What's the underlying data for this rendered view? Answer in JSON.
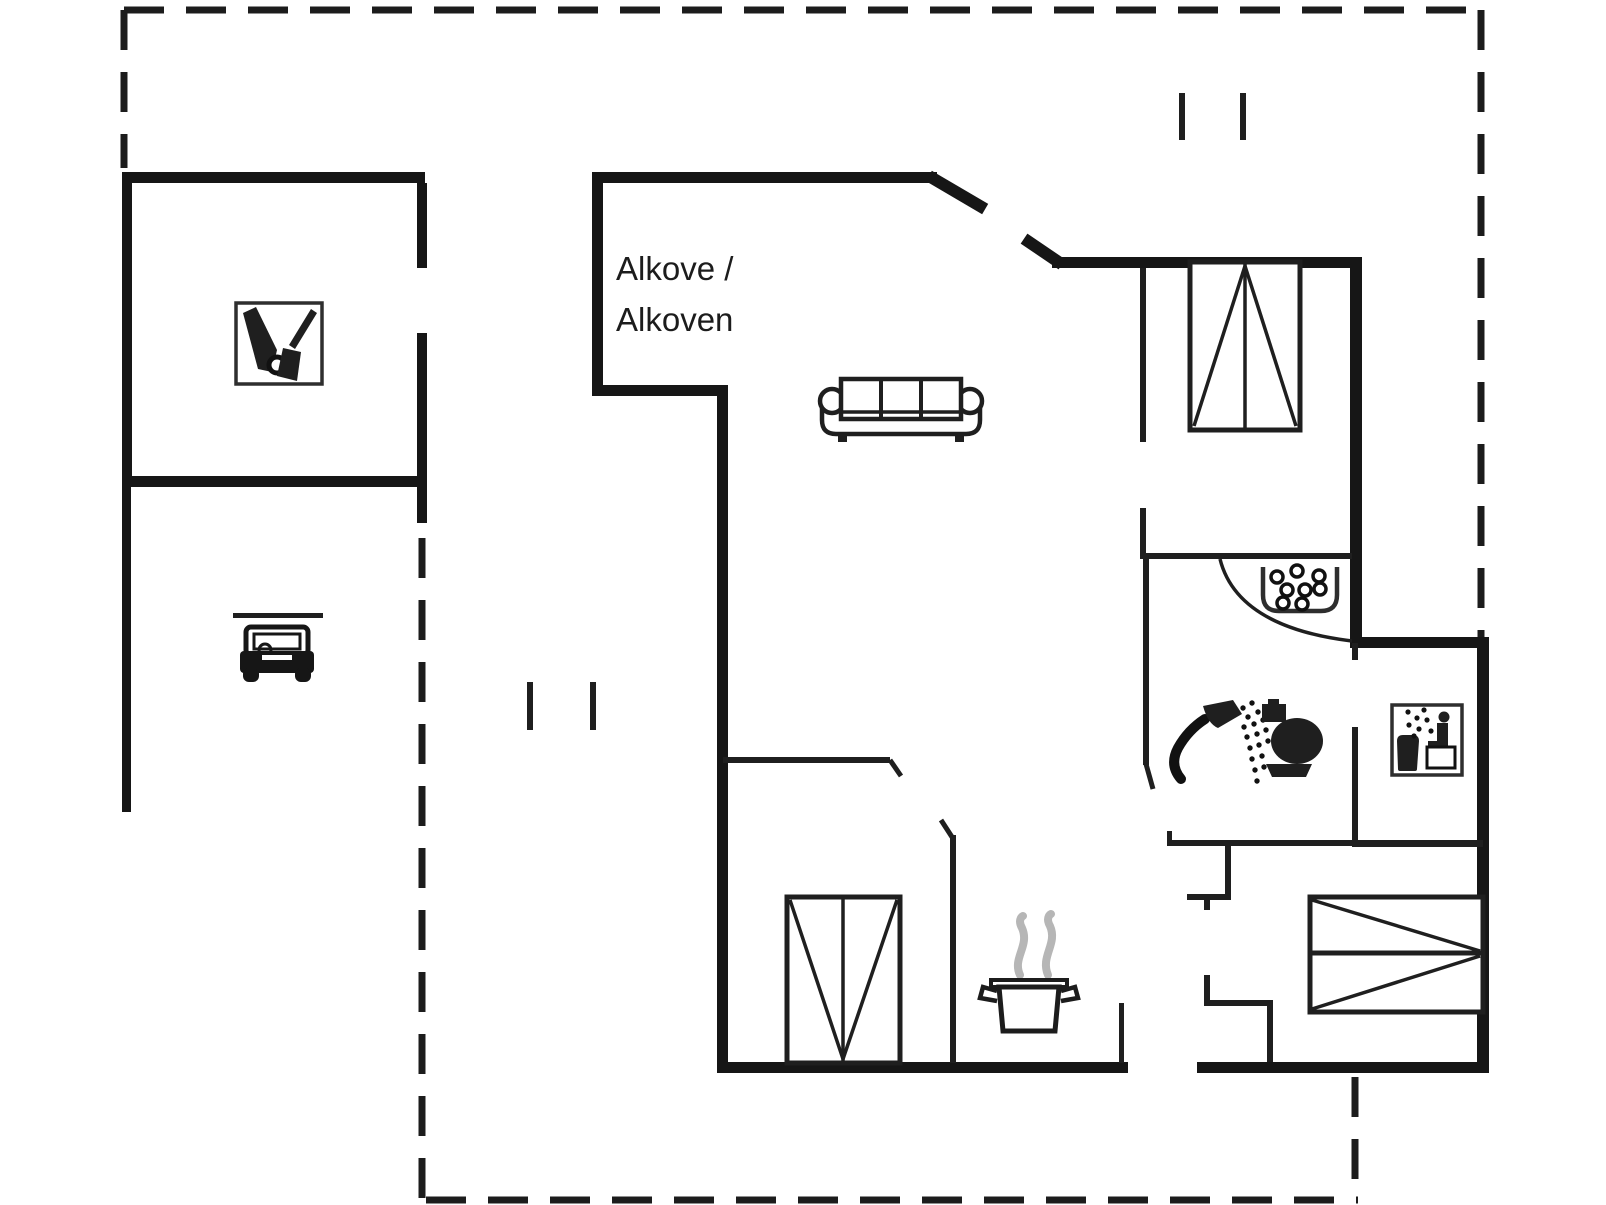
{
  "title": "Holiday home floor plan",
  "labels": {
    "alcove_line1": "Alkove /",
    "alcove_line2": "Alkoven"
  },
  "colors": {
    "wall": "#161616",
    "thin": "#1f1f1f",
    "bg": "#ffffff",
    "steam": "#b6b6b6",
    "iconborder": "#2e2e2e",
    "text": "#1c1c1c"
  },
  "icons": {
    "tool-shed-icon": "two garden tools with wheel in outlined square",
    "car-icon": "car front view under carport roof line",
    "sofa-icon": "three-seat sofa top view",
    "wardrobe-icon": "rectangle with center line and two triangles",
    "bunk-bed-icon": "rectangle with middle line and converging diagonals",
    "shower-icon": "hand shower with spray dots",
    "toilet-icon": "toilet silhouette side view",
    "sauna-icon": "person sitting in steam with bucket, outlined square",
    "washbasin-icon": "open basin with pebble circles",
    "cooking-pot-icon": "pot with handles and grey steam",
    "window-marker-icon": "pair of short parallel ticks"
  },
  "legend": {
    "dashed_line": "terrace / plot boundary",
    "thick_line": "exterior wall",
    "thin_line": "interior wall"
  }
}
